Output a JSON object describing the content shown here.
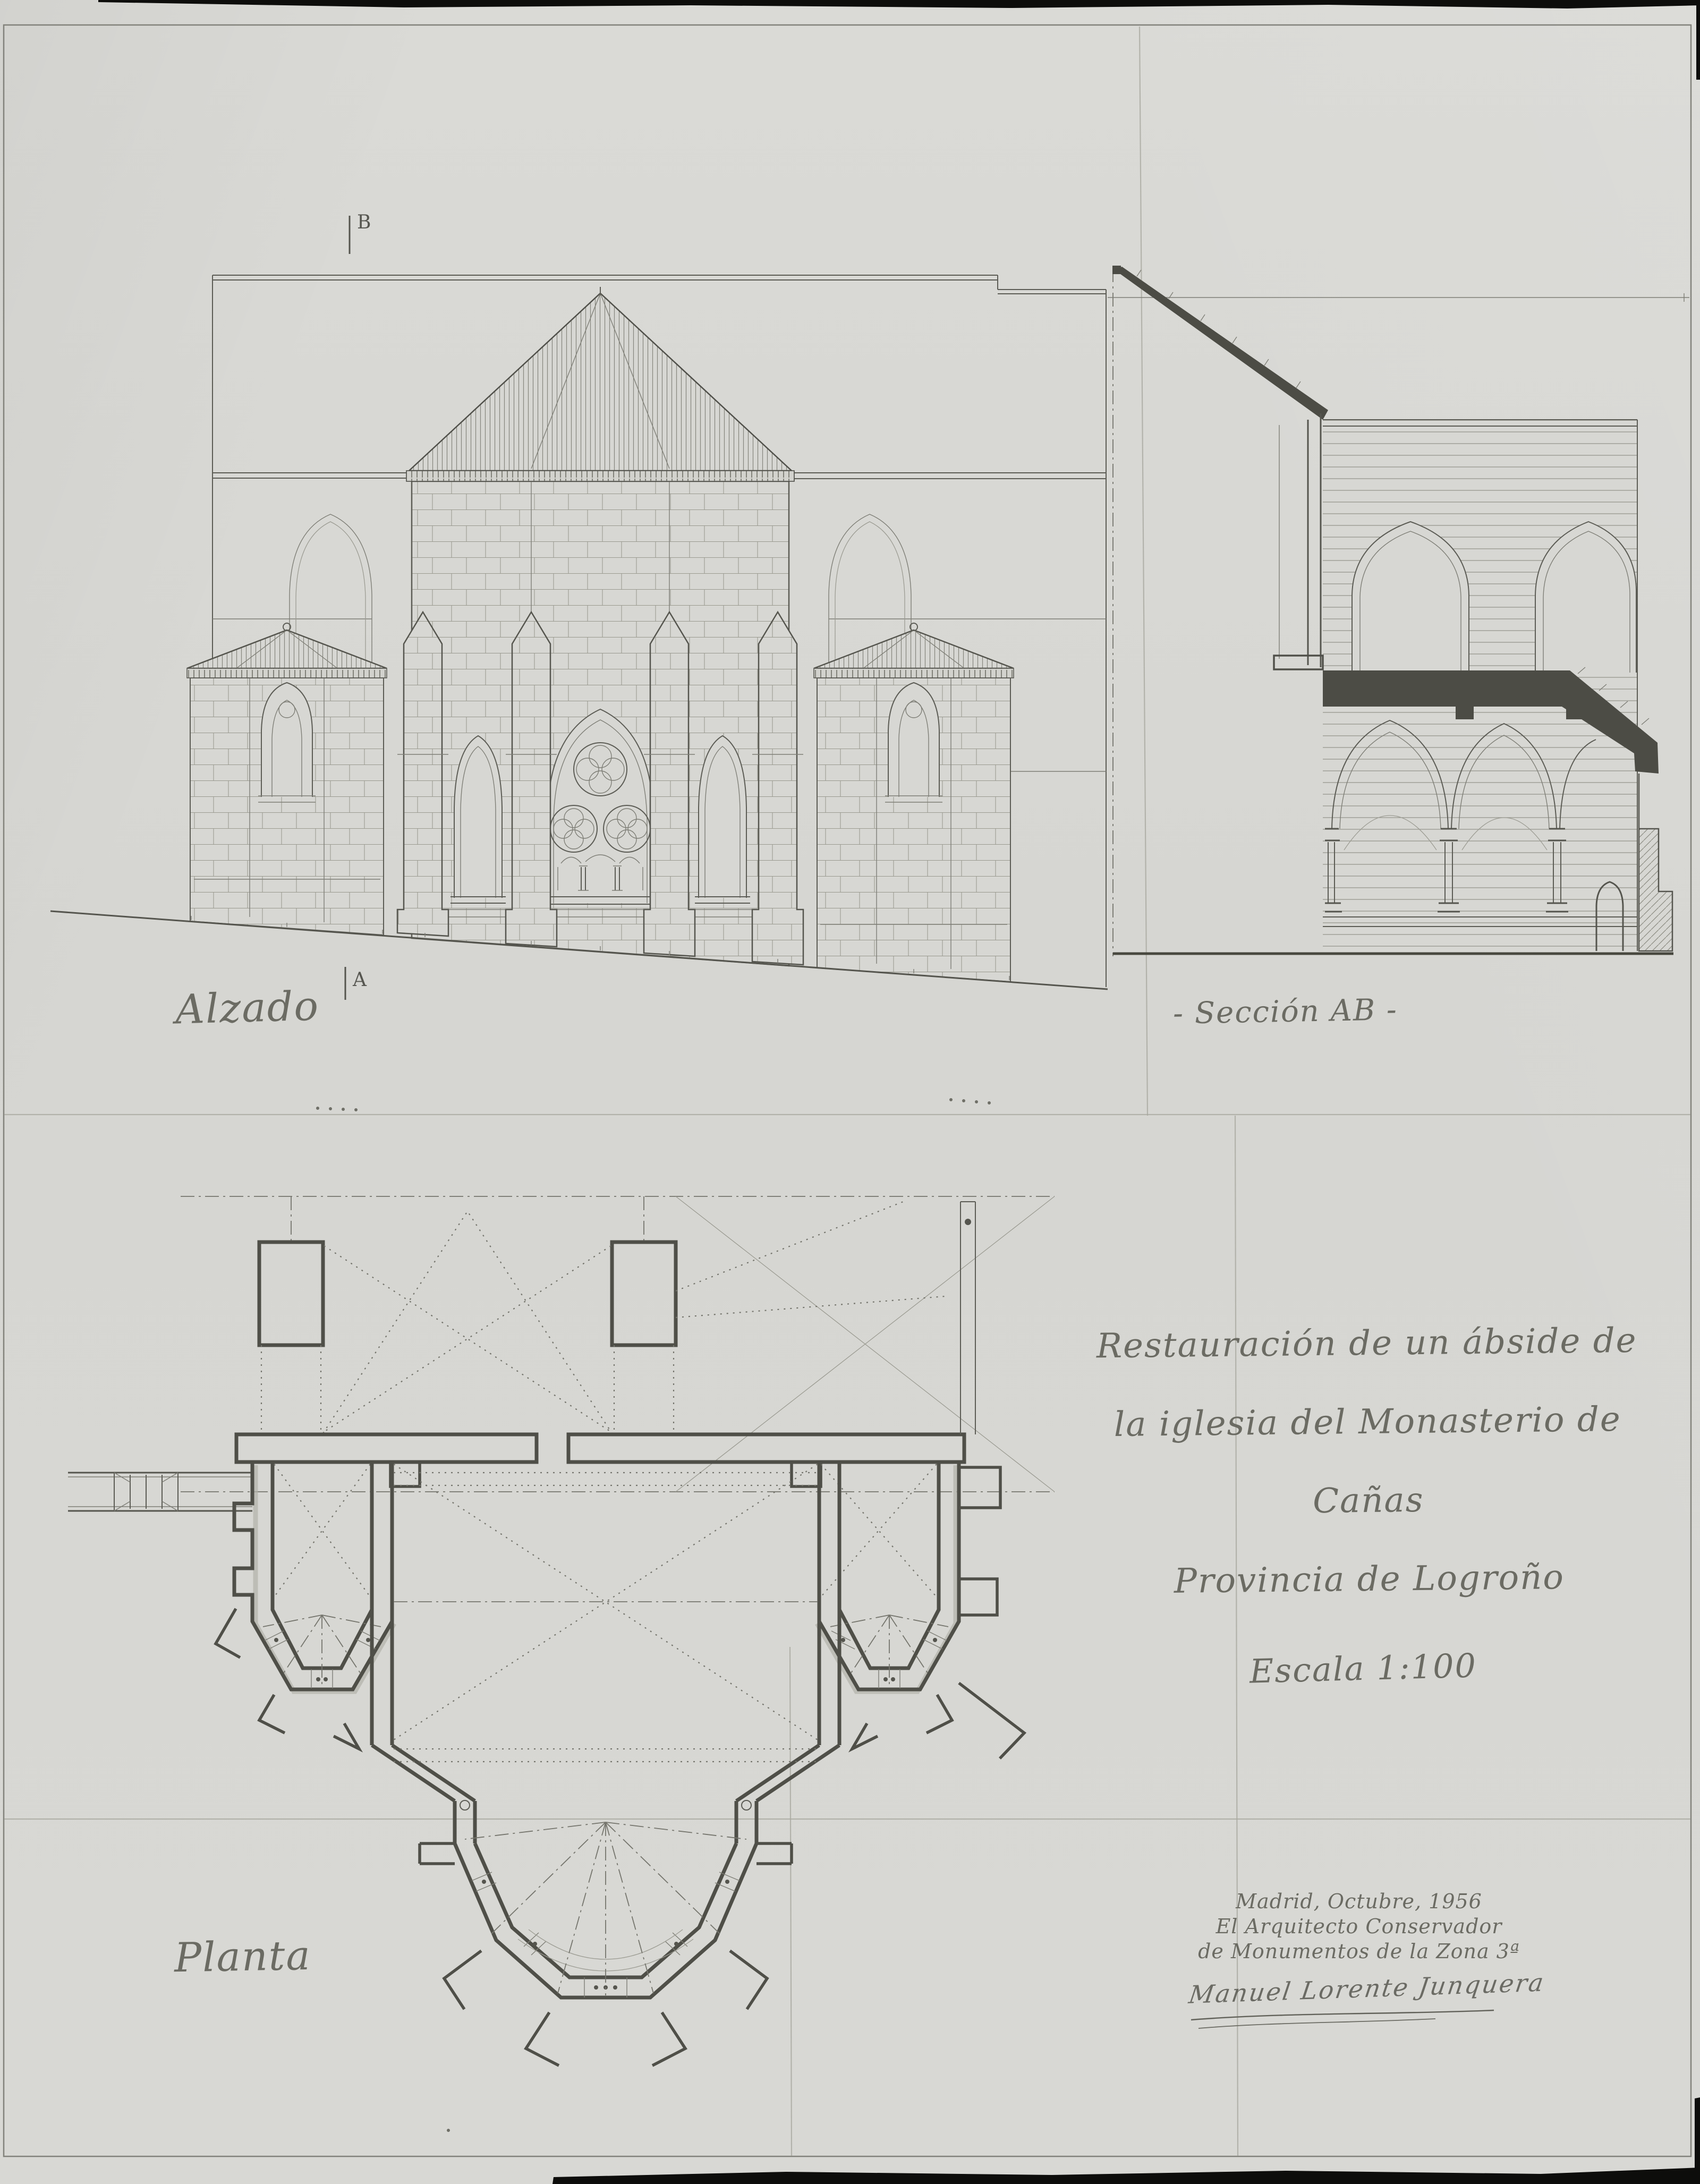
{
  "sheet": {
    "document_type": "architectural-drawing-scan",
    "title_lines": {
      "l1": "Restauración de un ábside de",
      "l2": "la iglesia del Monasterio de",
      "l3": "Cañas",
      "l4": "Provincia de Logroño"
    },
    "scale_label": "Escala 1:100",
    "credit": {
      "date_line": "Madrid, Octubre, 1956",
      "architect_line1": "El Arquitecto Conservador",
      "architect_line2": "de Monumentos de la Zona 3ª",
      "signature": "Manuel Lorente Junquera"
    },
    "drawings": {
      "elevation_label": "Alzado",
      "section_label": "- Sección AB -",
      "plan_label": "Planta",
      "marker_a": "A",
      "marker_b": "B"
    },
    "colors": {
      "paper": "#d7d7d3",
      "ink": "#5c5c55",
      "poche": "#4f4f48",
      "scan_black": "#0d0d0b"
    }
  }
}
